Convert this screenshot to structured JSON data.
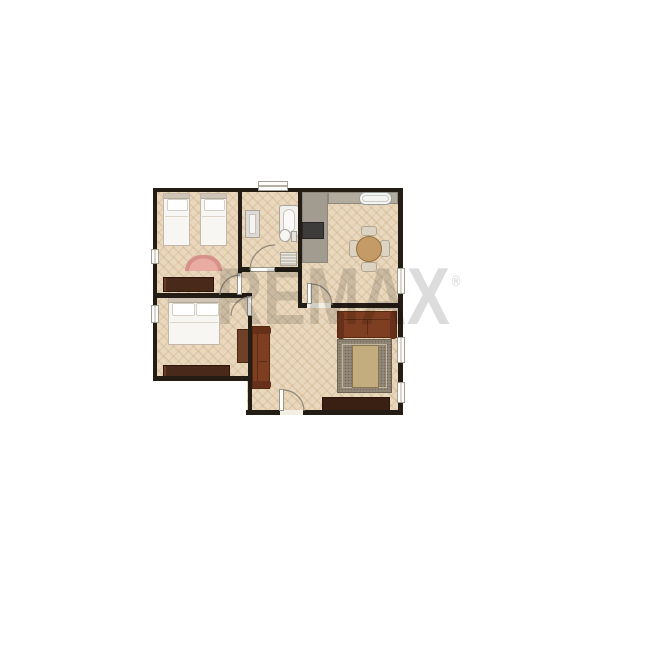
{
  "watermark": {
    "text": "REMAX",
    "registered": "®"
  },
  "palette": {
    "wall": "#241d15",
    "floor": "#e9d8bd",
    "counter_gray": "#a29c90",
    "sofa_brown": "#7d3e21",
    "dark_wood": "#49291a",
    "pink_rug": "#d8908a",
    "living_rug": "#938878",
    "table_wood": "#c49a66",
    "watermark_gray": "#dcdcdc"
  },
  "rooms": [
    {
      "name": "bedroom-top-left",
      "furniture": [
        "twin-bed",
        "twin-bed",
        "semicircle-rug",
        "dresser"
      ]
    },
    {
      "name": "bathroom",
      "furniture": [
        "washing-machine",
        "bathtub",
        "toilet",
        "bath-mat"
      ],
      "doors": 1,
      "windows": 1
    },
    {
      "name": "kitchen",
      "furniture": [
        "counter",
        "counter",
        "stove",
        "sink",
        "dining-table",
        "chair",
        "chair",
        "chair",
        "chair"
      ]
    },
    {
      "name": "bedroom-bottom-left",
      "furniture": [
        "double-bed",
        "dresser",
        "wardrobe"
      ]
    },
    {
      "name": "living-room",
      "furniture": [
        "sofa",
        "sofa",
        "area-rug",
        "coffee-table",
        "sideboard"
      ]
    }
  ]
}
